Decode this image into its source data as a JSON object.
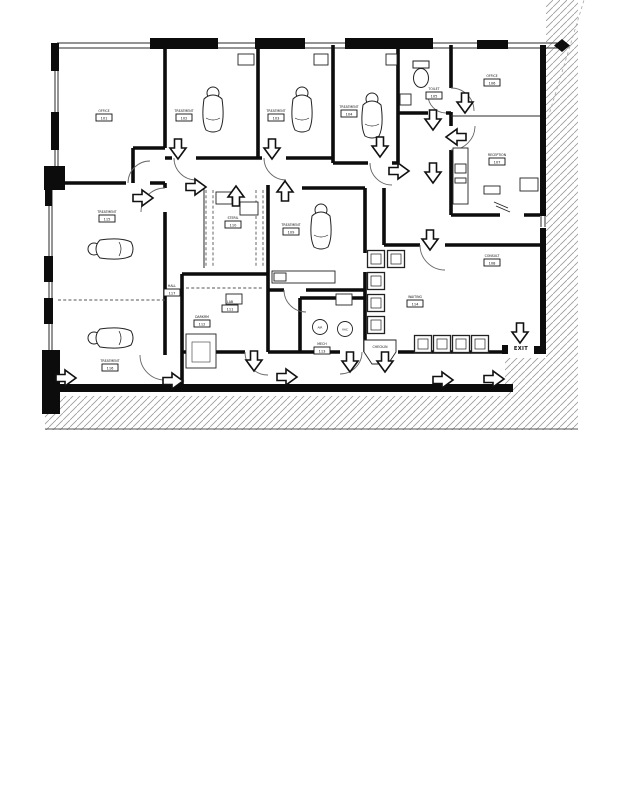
{
  "plan": {
    "exit": "EXIT",
    "colors": {
      "ink": "#0c0c0c",
      "hatch": "#9a9a9a"
    },
    "rooms": {
      "office_tl": {
        "name": "OFFICE",
        "num": "101"
      },
      "treat1": {
        "name": "TREATMENT",
        "num": "102"
      },
      "treat2": {
        "name": "TREATMENT",
        "num": "103"
      },
      "treat3": {
        "name": "TREATMENT",
        "num": "104"
      },
      "toilet": {
        "name": "TOILET",
        "num": "105"
      },
      "office_tr": {
        "name": "OFFICE",
        "num": "106"
      },
      "reception": {
        "name": "RECEPTION",
        "num": "107"
      },
      "consult": {
        "name": "CONSULT",
        "num": "108"
      },
      "operatory": {
        "name": "TREATMENT",
        "num": "109"
      },
      "steril": {
        "name": "STERIL",
        "num": "110"
      },
      "lab": {
        "name": "LAB",
        "num": "111"
      },
      "darkroom": {
        "name": "DARKRM",
        "num": "112"
      },
      "mech": {
        "name": "MECH",
        "num": "113"
      },
      "waiting": {
        "name": "WAITING",
        "num": "114"
      },
      "treat4": {
        "name": "TREATMENT",
        "num": "115"
      },
      "treat5": {
        "name": "TREATMENT",
        "num": "116"
      },
      "hall": {
        "name": "HALL",
        "num": "117"
      },
      "checkin": {
        "name": "CHECK-IN"
      }
    },
    "equipment": {
      "air": "AIR",
      "vac": "VAC"
    },
    "arrows": [
      {
        "x": 178,
        "y": 149,
        "dir": "down"
      },
      {
        "x": 272,
        "y": 149,
        "dir": "down"
      },
      {
        "x": 380,
        "y": 147,
        "dir": "down"
      },
      {
        "x": 143,
        "y": 198,
        "dir": "right"
      },
      {
        "x": 196,
        "y": 187,
        "dir": "right"
      },
      {
        "x": 236,
        "y": 196,
        "dir": "up"
      },
      {
        "x": 285,
        "y": 191,
        "dir": "up"
      },
      {
        "x": 433,
        "y": 120,
        "dir": "down"
      },
      {
        "x": 465,
        "y": 103,
        "dir": "down"
      },
      {
        "x": 456,
        "y": 137,
        "dir": "left"
      },
      {
        "x": 433,
        "y": 173,
        "dir": "down"
      },
      {
        "x": 399,
        "y": 171,
        "dir": "right"
      },
      {
        "x": 430,
        "y": 240,
        "dir": "down"
      },
      {
        "x": 254,
        "y": 361,
        "dir": "down"
      },
      {
        "x": 350,
        "y": 362,
        "dir": "down"
      },
      {
        "x": 385,
        "y": 362,
        "dir": "down"
      },
      {
        "x": 66,
        "y": 378,
        "dir": "right"
      },
      {
        "x": 173,
        "y": 381,
        "dir": "right"
      },
      {
        "x": 287,
        "y": 377,
        "dir": "right"
      },
      {
        "x": 443,
        "y": 380,
        "dir": "right"
      },
      {
        "x": 494,
        "y": 379,
        "dir": "right"
      },
      {
        "x": 520,
        "y": 333,
        "dir": "down"
      }
    ],
    "fixtures": [
      {
        "type": "dental-chair",
        "x": 213,
        "y": 112,
        "rot": 0
      },
      {
        "type": "dental-chair",
        "x": 302,
        "y": 112,
        "rot": 0
      },
      {
        "type": "dental-chair",
        "x": 372,
        "y": 118,
        "rot": 0
      },
      {
        "type": "dental-chair",
        "x": 321,
        "y": 229,
        "rot": 0
      },
      {
        "type": "dental-chair",
        "x": 113,
        "y": 249,
        "rot": -90
      },
      {
        "type": "dental-chair",
        "x": 113,
        "y": 338,
        "rot": -90
      },
      {
        "type": "toilet",
        "x": 421,
        "y": 76,
        "rot": 0
      },
      {
        "type": "waiting-chair",
        "x": 376,
        "y": 259,
        "rot": 0
      },
      {
        "type": "waiting-chair",
        "x": 396,
        "y": 259,
        "rot": 0
      },
      {
        "type": "waiting-chair",
        "x": 376,
        "y": 281,
        "rot": 0
      },
      {
        "type": "waiting-chair",
        "x": 376,
        "y": 303,
        "rot": 0
      },
      {
        "type": "waiting-chair",
        "x": 376,
        "y": 325,
        "rot": 0
      },
      {
        "type": "waiting-chair",
        "x": 423,
        "y": 344,
        "rot": 0
      },
      {
        "type": "waiting-chair",
        "x": 442,
        "y": 344,
        "rot": 0
      },
      {
        "type": "waiting-chair",
        "x": 461,
        "y": 344,
        "rot": 0
      },
      {
        "type": "waiting-chair",
        "x": 480,
        "y": 344,
        "rot": 0
      }
    ]
  }
}
